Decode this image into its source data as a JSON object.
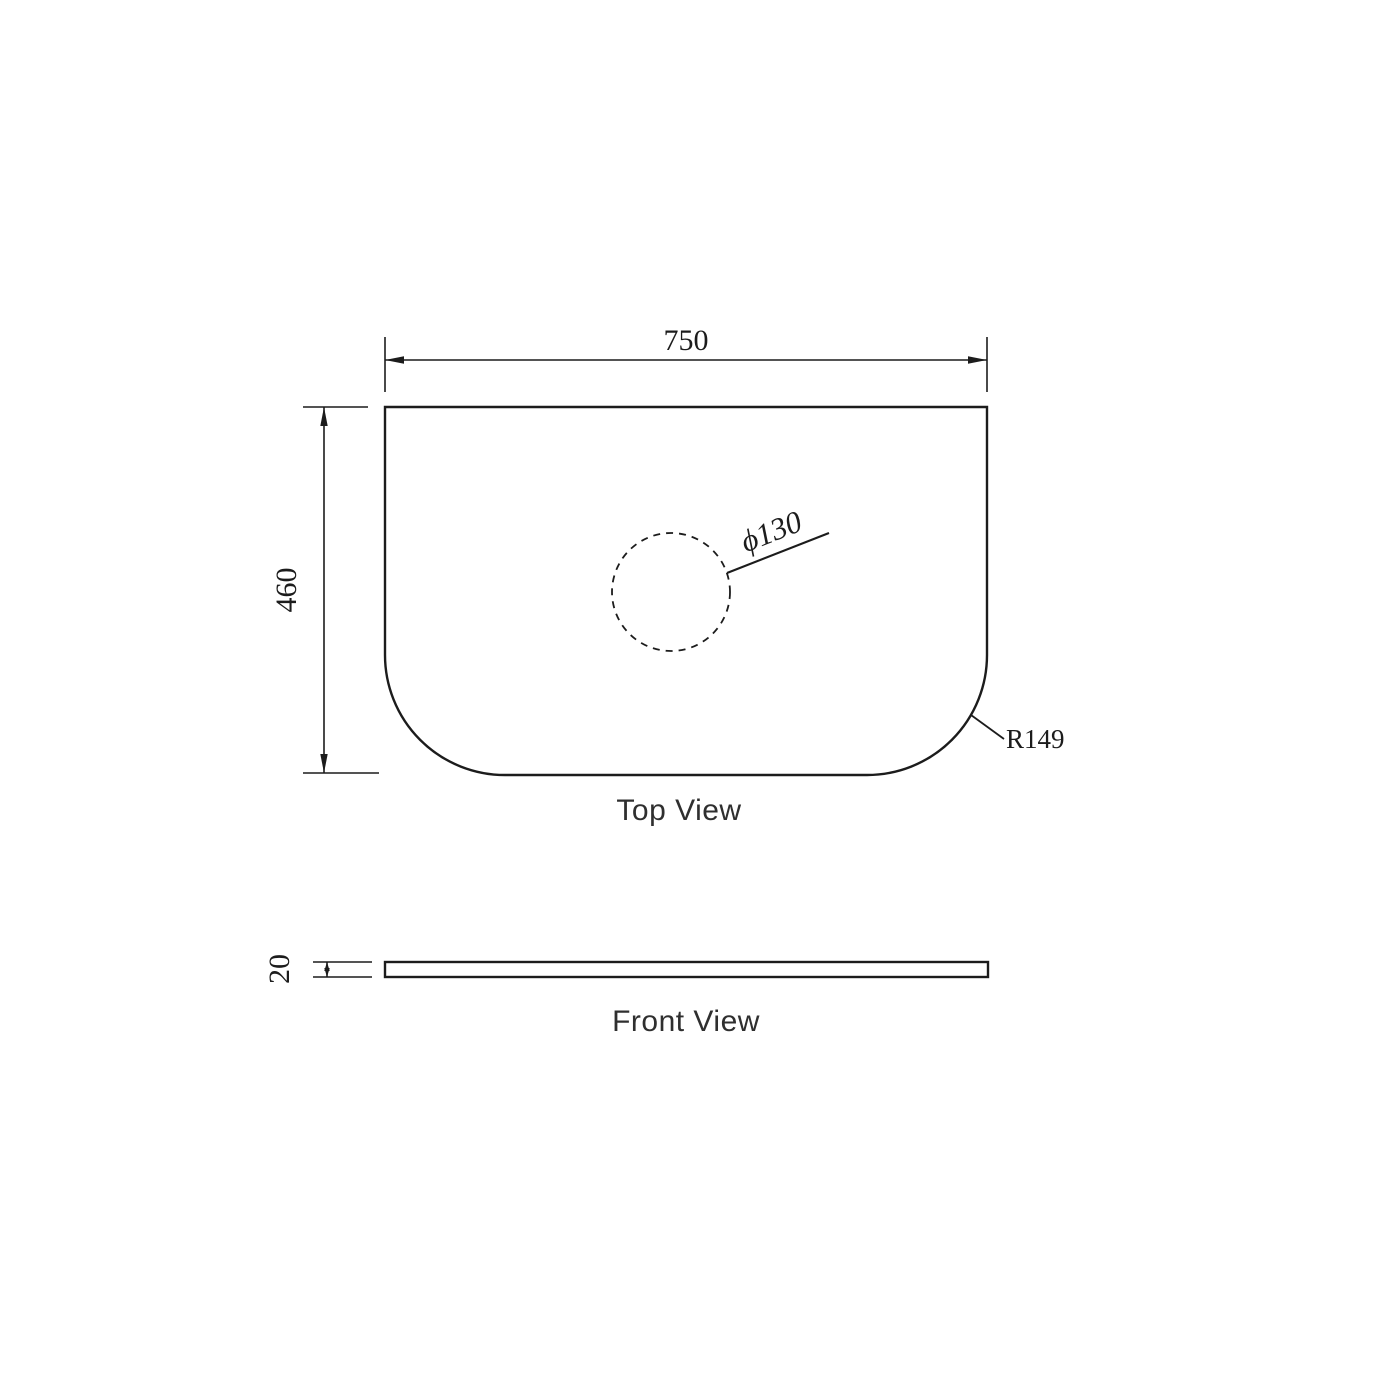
{
  "drawing": {
    "background_color": "#ffffff",
    "line_color": "#1c1c1c",
    "label_color": "#2f2f2f",
    "top_view": {
      "label": "Top View",
      "width_dim": "750",
      "depth_dim": "460",
      "hole_dim": "ϕ130",
      "corner_radius_dim": "R149"
    },
    "front_view": {
      "label": "Front View",
      "thickness_dim": "20"
    }
  }
}
